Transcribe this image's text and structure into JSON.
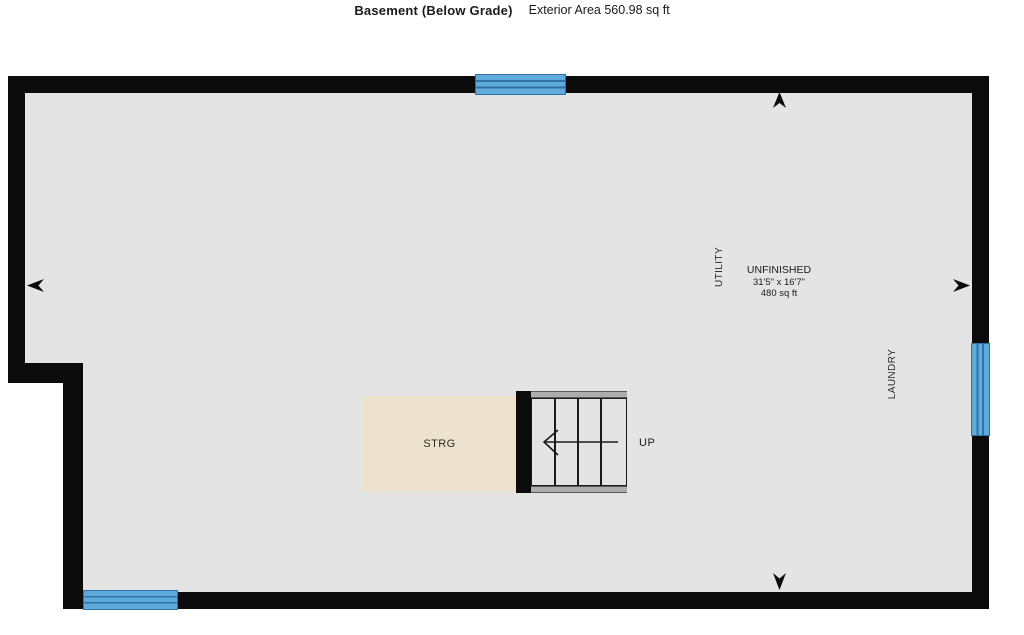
{
  "header": {
    "title": "Basement (Below Grade)",
    "subtitle": "Exterior Area 560.98 sq ft"
  },
  "rooms": {
    "unfinished": {
      "name": "UNFINISHED",
      "dimensions": "31'5\" x 16'7\"",
      "area": "480 sq ft"
    },
    "utility": {
      "name": "UTILITY"
    },
    "laundry": {
      "name": "LAUNDRY"
    },
    "storage": {
      "name": "STRG"
    }
  },
  "stairs": {
    "up_label": "UP",
    "tread_count": 4,
    "direction": "up, toward left"
  },
  "windows": [
    {
      "location": "top wall"
    },
    {
      "location": "right wall"
    },
    {
      "location": "bottom wall, left"
    }
  ],
  "colors": {
    "wall": "#0b0b0b",
    "floor": "#e3e4e3",
    "storage_fill": "#ece2cd",
    "window_blue": "#5fabdb",
    "window_line": "#2f73a3",
    "stair_rail": "#adadad",
    "background": "#ffffff"
  }
}
